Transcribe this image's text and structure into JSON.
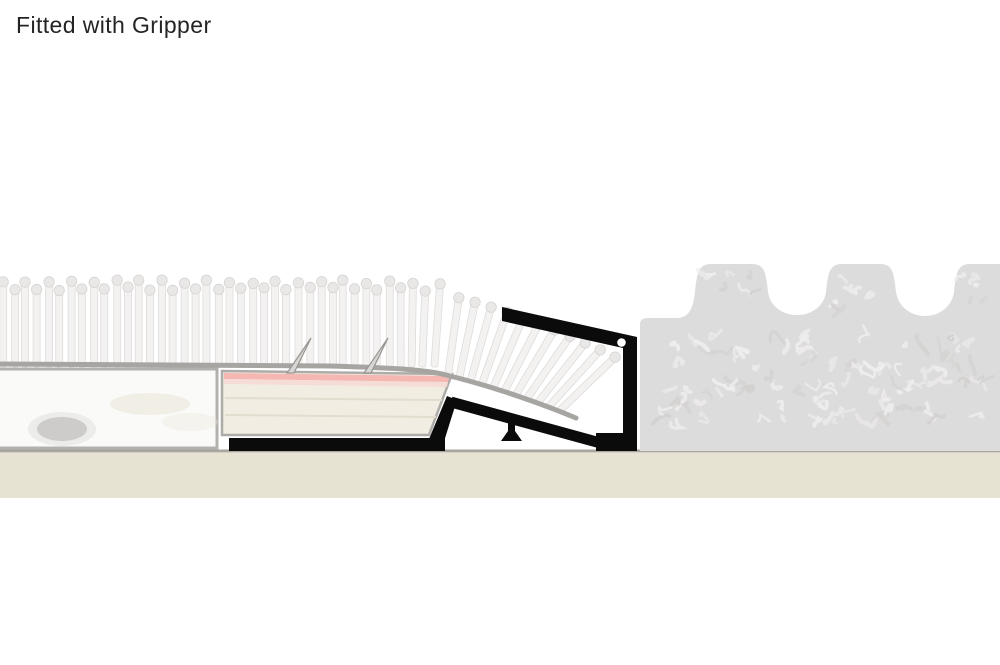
{
  "title": "Fitted with Gripper",
  "diagram": {
    "description": "carpet-gripper-cross-section",
    "colors": {
      "title_color": "#242424",
      "trim": "#0b0b0b",
      "screw_hole": "#ffffff",
      "carpet_pile": "#f3f2f1",
      "carpet_pile_outline": "#dedcdb",
      "carpet_cap": "#eae8e7",
      "carpet_cap_outline": "#d6d4d3",
      "carpet_backing": "#a7a5a2",
      "underlay_fill": "#fafaf9",
      "underlay_border": "#b3b1ae",
      "underlay_blob": "#aeacaa",
      "underlay_smudge": "#e9e6d6",
      "gripper_fill": "#f1ede3",
      "gripper_border": "#aeaca9",
      "gripper_pink": "#f4b7b1",
      "gripper_pink_light": "#f7d8d3",
      "gripper_grain": "#e3ddcf",
      "pin_fill": "#d8d6d4",
      "pin_outline": "#97958f",
      "right_carpet_fill": "#dddcdc",
      "right_carpet_texture_light": "#efeeee",
      "right_carpet_texture_dark": "#d2d1d0",
      "floor_fill": "#e7e3d3",
      "floor_line": "#a8a69e"
    }
  }
}
